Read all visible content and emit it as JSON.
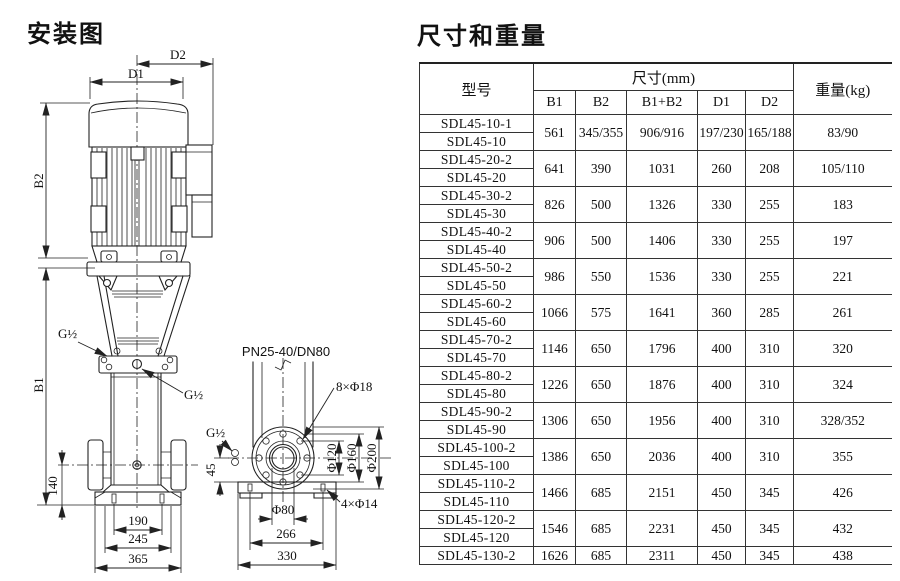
{
  "titles": {
    "installation": "安装图",
    "dimensions": "尺寸和重量"
  },
  "installation_diagram": {
    "labels": {
      "d1": "D1",
      "d2": "D2",
      "b1": "B1",
      "b2": "B2",
      "g_half": "G½",
      "dim_140": "140",
      "dim_190": "190",
      "dim_245": "245",
      "dim_365": "365",
      "flange_spec": "PN25-40/DN80",
      "bolt_holes_8": "8×Φ18",
      "bolt_holes_4": "4×Φ14",
      "dim_45": "45",
      "phi_120": "Φ120",
      "phi_160": "Φ160",
      "phi_200": "Φ200",
      "phi_80": "Φ80",
      "dim_266": "266",
      "dim_330": "330"
    }
  },
  "dimensions_table": {
    "header": {
      "model": "型号",
      "size_group": "尺寸(mm)",
      "weight": "重量(kg)",
      "size_cols": [
        "B1",
        "B2",
        "B1+B2",
        "D1",
        "D2"
      ]
    },
    "groups": [
      {
        "models": [
          "SDL45-10-1",
          "SDL45-10"
        ],
        "b1": "561",
        "b2": "345/355",
        "b1b2": "906/916",
        "d1": "197/230",
        "d2": "165/188",
        "weight": "83/90"
      },
      {
        "models": [
          "SDL45-20-2",
          "SDL45-20"
        ],
        "b1": "641",
        "b2": "390",
        "b1b2": "1031",
        "d1": "260",
        "d2": "208",
        "weight": "105/110"
      },
      {
        "models": [
          "SDL45-30-2",
          "SDL45-30"
        ],
        "b1": "826",
        "b2": "500",
        "b1b2": "1326",
        "d1": "330",
        "d2": "255",
        "weight": "183"
      },
      {
        "models": [
          "SDL45-40-2",
          "SDL45-40"
        ],
        "b1": "906",
        "b2": "500",
        "b1b2": "1406",
        "d1": "330",
        "d2": "255",
        "weight": "197"
      },
      {
        "models": [
          "SDL45-50-2",
          "SDL45-50"
        ],
        "b1": "986",
        "b2": "550",
        "b1b2": "1536",
        "d1": "330",
        "d2": "255",
        "weight": "221"
      },
      {
        "models": [
          "SDL45-60-2",
          "SDL45-60"
        ],
        "b1": "1066",
        "b2": "575",
        "b1b2": "1641",
        "d1": "360",
        "d2": "285",
        "weight": "261"
      },
      {
        "models": [
          "SDL45-70-2",
          "SDL45-70"
        ],
        "b1": "1146",
        "b2": "650",
        "b1b2": "1796",
        "d1": "400",
        "d2": "310",
        "weight": "320"
      },
      {
        "models": [
          "SDL45-80-2",
          "SDL45-80"
        ],
        "b1": "1226",
        "b2": "650",
        "b1b2": "1876",
        "d1": "400",
        "d2": "310",
        "weight": "324"
      },
      {
        "models": [
          "SDL45-90-2",
          "SDL45-90"
        ],
        "b1": "1306",
        "b2": "650",
        "b1b2": "1956",
        "d1": "400",
        "d2": "310",
        "weight": "328/352"
      },
      {
        "models": [
          "SDL45-100-2",
          "SDL45-100"
        ],
        "b1": "1386",
        "b2": "650",
        "b1b2": "2036",
        "d1": "400",
        "d2": "310",
        "weight": "355"
      },
      {
        "models": [
          "SDL45-110-2",
          "SDL45-110"
        ],
        "b1": "1466",
        "b2": "685",
        "b1b2": "2151",
        "d1": "450",
        "d2": "345",
        "weight": "426"
      },
      {
        "models": [
          "SDL45-120-2",
          "SDL45-120"
        ],
        "b1": "1546",
        "b2": "685",
        "b1b2": "2231",
        "d1": "450",
        "d2": "345",
        "weight": "432"
      },
      {
        "models": [
          "SDL45-130-2"
        ],
        "b1": "1626",
        "b2": "685",
        "b1b2": "2311",
        "d1": "450",
        "d2": "345",
        "weight": "438"
      }
    ]
  }
}
